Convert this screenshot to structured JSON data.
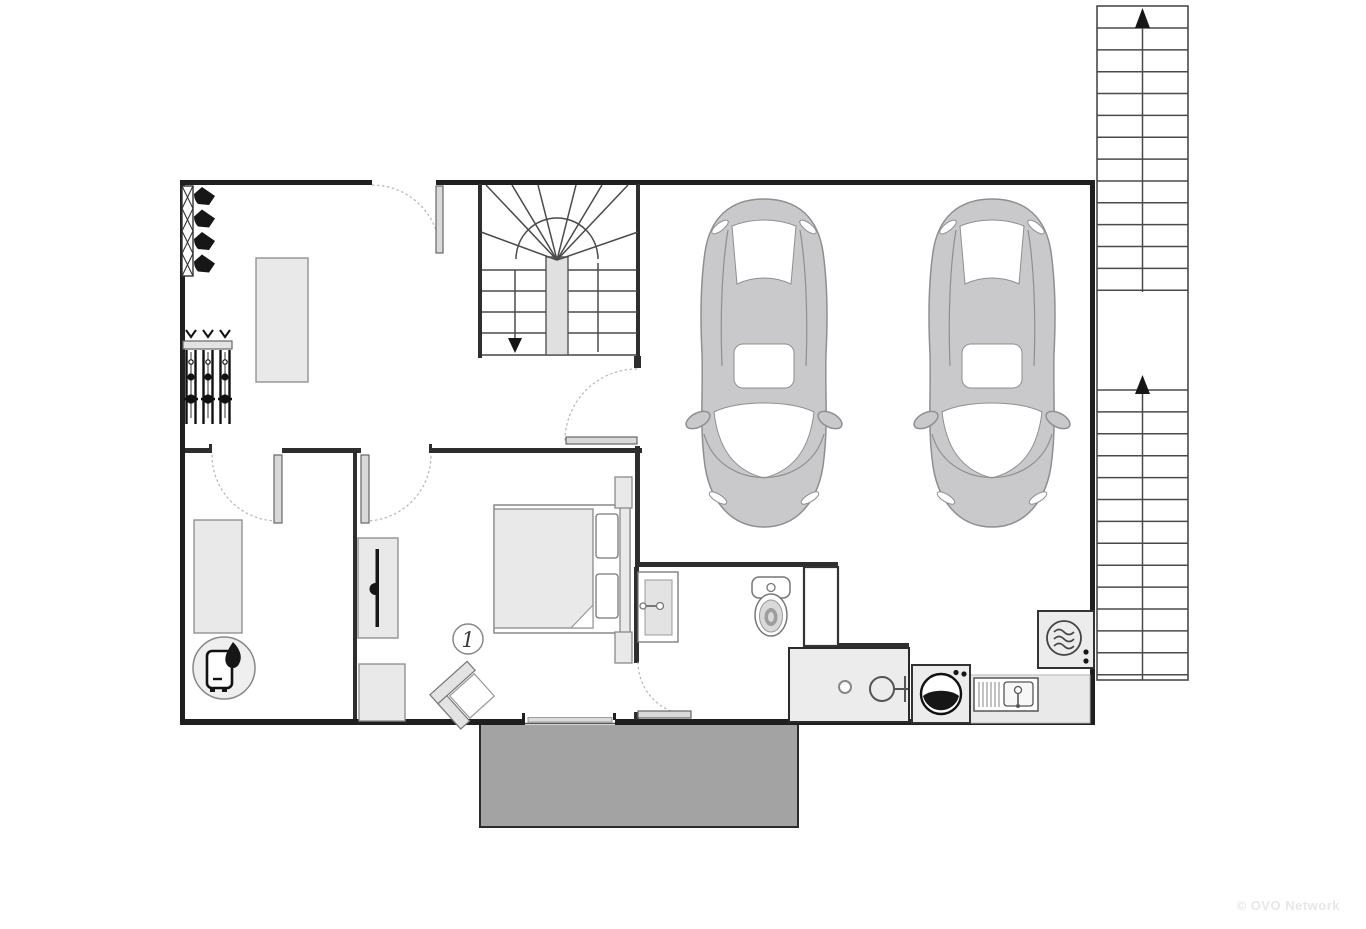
{
  "page": {
    "background": "#ffffff"
  },
  "watermark": {
    "text": "© OVO Network",
    "color": "#e7e7e7"
  },
  "labels": {
    "room_number": "1"
  },
  "palette": {
    "wall": "#1f1f1f",
    "furniture_fill": "#e9e9e9",
    "appliance_fill": "#ececec",
    "car_fill": "#c9c9cc",
    "terrace_fill": "#a3a3a3",
    "door_leaf": "#d9d9d9",
    "stair_line": "#4a4a4a",
    "watermark": "#e7e7e7"
  },
  "icons": {
    "boiler-icon": "water heater with flame",
    "ski-boot-icon": "ski boot on warmer rack",
    "ski-rack-icon": "skis and poles on wall rack",
    "tv-icon": "wall-mounted tv",
    "bed-icon": "double bed with pillows",
    "armchair-icon": "angled armchair",
    "sink-icon": "washbasin",
    "toilet-icon": "toilet",
    "shower-icon": "walk-in shower",
    "washing-machine-icon": "front-load washer",
    "laundry-sink-icon": "utility sink with drainer",
    "dryer-icon": "tumble dryer",
    "car-icon": "car top view",
    "stairs-up-icon": "staircase arrow up",
    "stairs-down-icon": "staircase arrow down"
  },
  "external_staircase": {
    "flight1_steps": 13,
    "flight2_steps": 14,
    "direction": "up"
  },
  "internal_staircase": {
    "straight_steps_per_side": 4,
    "winder_lines": 8,
    "direction": "down"
  },
  "ski_room": {
    "boot_count": 4,
    "ski_pairs": 3,
    "rack_cells": 4
  },
  "garage": {
    "car_count": 2
  }
}
